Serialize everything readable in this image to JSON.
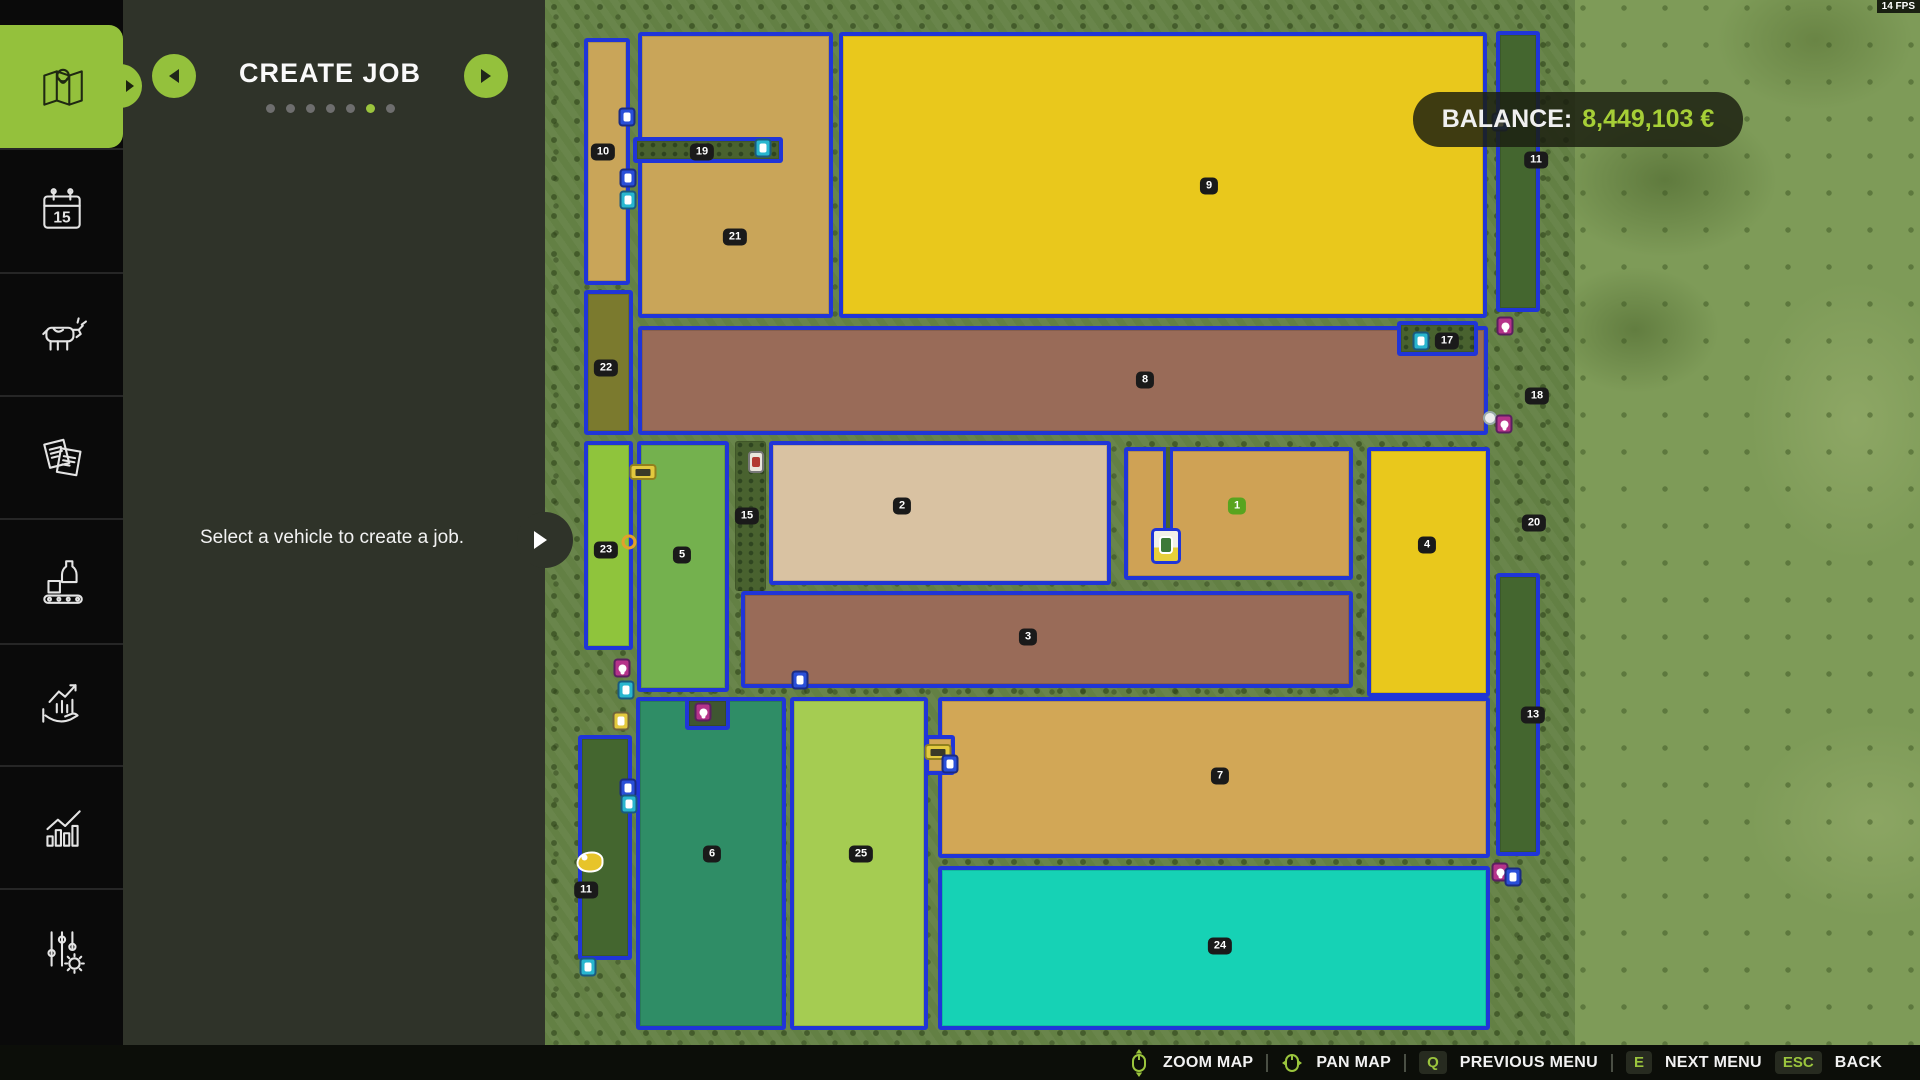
{
  "header": {
    "title": "CREATE JOB",
    "dots": {
      "count": 7,
      "active_index": 5
    }
  },
  "panel": {
    "message": "Select a vehicle to create a job."
  },
  "sidebar": {
    "calendar_day": "15",
    "items": [
      {
        "id": "map",
        "active": true
      },
      {
        "id": "calendar",
        "active": false
      },
      {
        "id": "animals",
        "active": false
      },
      {
        "id": "contracts",
        "active": false
      },
      {
        "id": "production",
        "active": false
      },
      {
        "id": "finances",
        "active": false
      },
      {
        "id": "statistics",
        "active": false
      },
      {
        "id": "settings",
        "active": false
      }
    ]
  },
  "balance": {
    "label": "BALANCE:",
    "value": "8,449,103 €"
  },
  "fps": "14 FPS",
  "bottom_bar": {
    "items": [
      {
        "icon": "mouse-zoom-icon",
        "label": "ZOOM MAP",
        "divider_after": true
      },
      {
        "icon": "mouse-pan-icon",
        "label": "PAN MAP",
        "divider_after": true
      },
      {
        "key": "Q",
        "label": "PREVIOUS MENU",
        "divider_after": true
      },
      {
        "key": "E",
        "label": "NEXT MENU",
        "divider_after": false
      },
      {
        "key": "ESC",
        "label": "BACK",
        "divider_after": false
      }
    ]
  },
  "map": {
    "border_color": "#2035d8",
    "fields": [
      {
        "n": "10",
        "x": 584,
        "y": 38,
        "w": 46,
        "h": 247,
        "f": "#c9a559",
        "lx": 603,
        "ly": 152
      },
      {
        "n": "21",
        "x": 638,
        "y": 32,
        "w": 195,
        "h": 286,
        "f": "#c9a559",
        "lx": 735,
        "ly": 237
      },
      {
        "n": "9",
        "x": 839,
        "y": 32,
        "w": 648,
        "h": 286,
        "f": "#e9c81c",
        "lx": 1209,
        "ly": 186
      },
      {
        "n": "11",
        "x": 1496,
        "y": 31,
        "w": 44,
        "h": 281,
        "f": "#44662f",
        "lx": 1536,
        "ly": 160
      },
      {
        "n": "19",
        "x": 633,
        "y": 137,
        "w": 150,
        "h": 26,
        "f": "dots",
        "lx": 702,
        "ly": 152
      },
      {
        "n": "22",
        "x": 584,
        "y": 290,
        "w": 49,
        "h": 145,
        "f": "#7b7a2e",
        "lx": 606,
        "ly": 368
      },
      {
        "n": "8",
        "x": 638,
        "y": 326,
        "w": 850,
        "h": 109,
        "f": "#996b58",
        "lx": 1145,
        "ly": 380
      },
      {
        "n": "17",
        "x": 1397,
        "y": 321,
        "w": 81,
        "h": 35,
        "f": "dots",
        "lx": 1447,
        "ly": 341
      },
      {
        "n": "23",
        "x": 584,
        "y": 441,
        "w": 49,
        "h": 209,
        "f": "#8fc43c",
        "lx": 606,
        "ly": 550
      },
      {
        "n": "5",
        "x": 637,
        "y": 441,
        "w": 92,
        "h": 251,
        "f": "#74b14e",
        "lx": 682,
        "ly": 555
      },
      {
        "n": "15",
        "x": 735,
        "y": 441,
        "w": 31,
        "h": 150,
        "f": "dots",
        "nb": true,
        "lx": 747,
        "ly": 516
      },
      {
        "n": "2",
        "x": 769,
        "y": 441,
        "w": 342,
        "h": 144,
        "f": "#d9c2a2",
        "lx": 902,
        "ly": 506
      },
      {
        "n": "1",
        "x": 1124,
        "y": 447,
        "w": 229,
        "h": 133,
        "f": "#cfa255",
        "lx": 1237,
        "ly": 506,
        "green": true
      },
      {
        "n": "4",
        "x": 1367,
        "y": 447,
        "w": 123,
        "h": 250,
        "f": "#e9c81c",
        "lx": 1427,
        "ly": 545
      },
      {
        "n": "3",
        "x": 741,
        "y": 591,
        "w": 612,
        "h": 97,
        "f": "#996b58",
        "lx": 1028,
        "ly": 637
      },
      {
        "n": "13",
        "x": 1496,
        "y": 573,
        "w": 44,
        "h": 283,
        "f": "#44662f",
        "lx": 1533,
        "ly": 715
      },
      {
        "n": "6",
        "x": 636,
        "y": 697,
        "w": 150,
        "h": 333,
        "f": "#2f8d66",
        "lx": 712,
        "ly": 854
      },
      {
        "n": "25",
        "x": 790,
        "y": 697,
        "w": 138,
        "h": 333,
        "f": "#a5cc52",
        "lx": 861,
        "ly": 854
      },
      {
        "n": "7",
        "x": 938,
        "y": 697,
        "w": 552,
        "h": 161,
        "f": "#d2a756",
        "lx": 1220,
        "ly": 776
      },
      {
        "n": "24",
        "x": 938,
        "y": 866,
        "w": 552,
        "h": 164,
        "f": "#16d2b5",
        "lx": 1220,
        "ly": 946
      },
      {
        "n": "11",
        "x": 578,
        "y": 735,
        "w": 54,
        "h": 225,
        "f": "#44662f",
        "lx": 586,
        "ly": 890
      },
      {
        "x": 685,
        "y": 697,
        "w": 45,
        "h": 33,
        "f": "#3f5631"
      },
      {
        "x": 925,
        "y": 735,
        "w": 30,
        "h": 40,
        "f": "#d2a756"
      }
    ],
    "area_labels": [
      {
        "t": "18",
        "x": 1537,
        "y": 396
      },
      {
        "t": "20",
        "x": 1534,
        "y": 523
      }
    ],
    "lane": {
      "x": 1163,
      "y": 447,
      "w": 10,
      "h": 86,
      "box": {
        "x": 1151,
        "y": 528,
        "w": 30,
        "h": 36
      }
    },
    "markers": [
      {
        "x": 627,
        "y": 117,
        "c": "#2a4fd8",
        "t": "v",
        "name": "vehicle-icon"
      },
      {
        "x": 763,
        "y": 148,
        "c": "#29b6cf",
        "t": "v",
        "name": "vehicle-icon"
      },
      {
        "x": 628,
        "y": 178,
        "c": "#2a4fd8",
        "t": "v",
        "name": "vehicle-icon"
      },
      {
        "x": 628,
        "y": 200,
        "c": "#29b6cf",
        "t": "v",
        "name": "vehicle-icon"
      },
      {
        "x": 643,
        "y": 472,
        "c": "#e3c93e",
        "t": "y",
        "name": "vehicle-group-icon"
      },
      {
        "x": 629,
        "y": 542,
        "t": "r",
        "name": "ring-marker-icon"
      },
      {
        "x": 756,
        "y": 462,
        "t": "h",
        "name": "harvester-icon"
      },
      {
        "x": 800,
        "y": 680,
        "c": "#2a4fd8",
        "t": "v",
        "name": "vehicle-icon"
      },
      {
        "x": 703,
        "y": 712,
        "c": "#b5338a",
        "t": "p",
        "name": "pin-marker-icon"
      },
      {
        "x": 938,
        "y": 752,
        "c": "#e3c93e",
        "t": "y",
        "name": "vehicle-group-icon"
      },
      {
        "x": 950,
        "y": 764,
        "c": "#2a4fd8",
        "t": "v",
        "name": "vehicle-icon"
      },
      {
        "x": 622,
        "y": 668,
        "c": "#b5338a",
        "t": "p",
        "name": "pin-marker-icon"
      },
      {
        "x": 626,
        "y": 690,
        "c": "#29b6cf",
        "t": "v",
        "name": "vehicle-icon"
      },
      {
        "x": 621,
        "y": 721,
        "c": "#e3c93e",
        "t": "v",
        "name": "vehicle-icon"
      },
      {
        "x": 628,
        "y": 788,
        "c": "#2a4fd8",
        "t": "v",
        "name": "vehicle-icon"
      },
      {
        "x": 629,
        "y": 804,
        "c": "#29b6cf",
        "t": "v",
        "name": "vehicle-icon"
      },
      {
        "x": 590,
        "y": 862,
        "t": "d",
        "name": "duck-icon"
      },
      {
        "x": 588,
        "y": 967,
        "c": "#29b6cf",
        "t": "v",
        "name": "vehicle-icon"
      },
      {
        "x": 1421,
        "y": 341,
        "c": "#29b6cf",
        "t": "v",
        "name": "vehicle-icon"
      },
      {
        "x": 1505,
        "y": 326,
        "c": "#b5338a",
        "t": "p",
        "name": "pin-marker-icon"
      },
      {
        "x": 1490,
        "y": 418,
        "t": "w",
        "name": "circle-marker-icon"
      },
      {
        "x": 1504,
        "y": 424,
        "c": "#b5338a",
        "t": "p",
        "name": "pin-marker-icon"
      },
      {
        "x": 1500,
        "y": 872,
        "c": "#b5338a",
        "t": "p",
        "name": "pin-marker-icon"
      },
      {
        "x": 1513,
        "y": 877,
        "c": "#2a4fd8",
        "t": "v",
        "name": "vehicle-icon"
      },
      {
        "x": 1500,
        "y": 122,
        "c": "#2a4fd8",
        "t": "v",
        "name": "vehicle-icon"
      }
    ]
  }
}
